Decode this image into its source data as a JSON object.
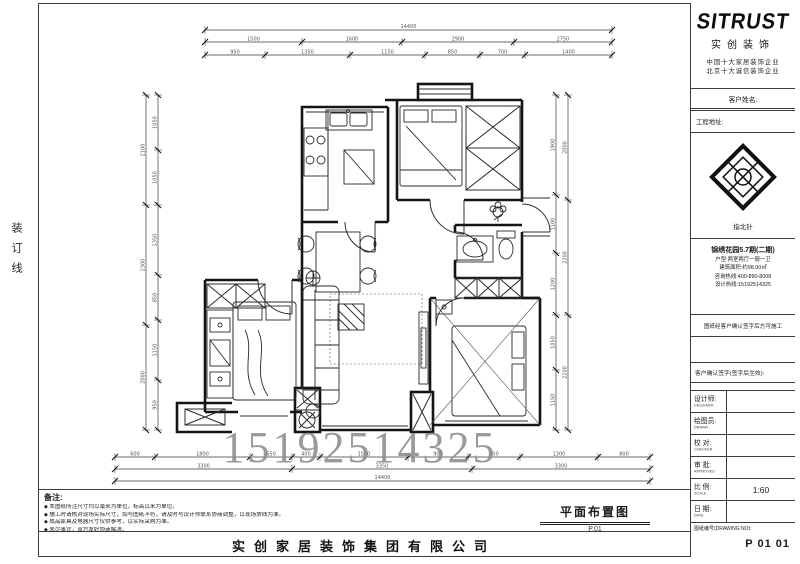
{
  "page": {
    "binding_text": "装订线"
  },
  "watermark": {
    "text": "15192514325"
  },
  "company": "实创家居装饰集团有限公司",
  "notes": {
    "heading": "备注:",
    "items": [
      "本图纸所注尺寸均以毫米为单位，标高以米为单位。",
      "施工时请核对现场实际尺寸，如与图纸不符，请及时与设计师联系协商调整，以现场放线为准。",
      "成品家具及电器尺寸仅供参考，以实际采购为准。",
      "未尽事宜，双方友好协商解决。"
    ]
  },
  "plan": {
    "title": "平面布置图",
    "title_sub": "P.01",
    "chains": [
      {
        "dir": "h",
        "x": 205,
        "y": 42,
        "segs": [
          {
            "len": 97,
            "label": "1500"
          },
          {
            "len": 100,
            "label": "1600"
          },
          {
            "len": 112,
            "label": "2900"
          },
          {
            "len": 98,
            "label": "2750"
          }
        ]
      },
      {
        "dir": "h",
        "x": 205,
        "y": 55,
        "segs": [
          {
            "len": 60,
            "label": "950"
          },
          {
            "len": 85,
            "label": "1350"
          },
          {
            "len": 75,
            "label": "1150"
          },
          {
            "len": 55,
            "label": "850"
          },
          {
            "len": 45,
            "label": "700"
          },
          {
            "len": 87,
            "label": "1400"
          }
        ]
      },
      {
        "dir": "h",
        "x": 115,
        "y": 457,
        "segs": [
          {
            "len": 40,
            "label": "600"
          },
          {
            "len": 95,
            "label": "1800"
          },
          {
            "len": 42,
            "label": "650"
          },
          {
            "len": 28,
            "label": "400"
          },
          {
            "len": 88,
            "label": "1500"
          },
          {
            "len": 60,
            "label": "900"
          },
          {
            "len": 52,
            "label": "800"
          },
          {
            "len": 78,
            "label": "1300"
          },
          {
            "len": 52,
            "label": "800"
          }
        ]
      },
      {
        "dir": "h",
        "x": 115,
        "y": 469,
        "segs": [
          {
            "len": 177,
            "label": "3300"
          },
          {
            "len": 180,
            "label": "3350"
          },
          {
            "len": 178,
            "label": "3300"
          }
        ]
      },
      {
        "dir": "v",
        "x": 146,
        "y": 95,
        "segs": [
          {
            "len": 110,
            "label": "2100"
          },
          {
            "len": 120,
            "label": "2300"
          },
          {
            "len": 105,
            "label": "2000"
          }
        ]
      },
      {
        "dir": "v",
        "x": 158,
        "y": 95,
        "segs": [
          {
            "len": 55,
            "label": "1050"
          },
          {
            "len": 55,
            "label": "1050"
          },
          {
            "len": 70,
            "label": "1350"
          },
          {
            "len": 45,
            "label": "850"
          },
          {
            "len": 60,
            "label": "1150"
          },
          {
            "len": 50,
            "label": "950"
          }
        ]
      },
      {
        "dir": "v",
        "x": 556,
        "y": 95,
        "segs": [
          {
            "len": 100,
            "label": "1900"
          },
          {
            "len": 58,
            "label": "1100"
          },
          {
            "len": 62,
            "label": "1200"
          },
          {
            "len": 55,
            "label": "1050"
          },
          {
            "len": 60,
            "label": "1150"
          }
        ]
      },
      {
        "dir": "v",
        "x": 568,
        "y": 95,
        "segs": [
          {
            "len": 105,
            "label": "2000"
          },
          {
            "len": 115,
            "label": "2200"
          },
          {
            "len": 115,
            "label": "2200"
          }
        ]
      }
    ],
    "overalls": [
      {
        "dir": "h",
        "x": 205,
        "y": 30,
        "len": 407,
        "label": "14400"
      },
      {
        "dir": "h",
        "x": 115,
        "y": 481,
        "len": 535,
        "label": "14400"
      }
    ]
  },
  "titleblock": {
    "logo": "SITRUST",
    "logo_cn": "实创装饰",
    "slogan1": "中国十大家居装饰企业",
    "slogan2": "北京十大诚信装饰企业",
    "row_customer": "客户姓名:",
    "row_address": "工程地址:",
    "compass_caption": "指北针",
    "info_lines": [
      "锦绣花园5.7期(二期)",
      "户型:两室两厅一厨一卫",
      "建筑面积:约98.00㎡",
      "咨询热线:400-890-8008",
      "设计热线:15192514325"
    ],
    "confirm_row": "图纸经客户确认签字后方可施工",
    "sign_row": "客户确认签字(签字后生效):",
    "fields": [
      {
        "label": "设计师:",
        "sub": "DESIGNER",
        "value": ""
      },
      {
        "label": "绘图员:",
        "sub": "DRAWN",
        "value": ""
      },
      {
        "label": "校 对:",
        "sub": "CHECKER",
        "value": ""
      },
      {
        "label": "审 批:",
        "sub": "APPROVED",
        "value": ""
      },
      {
        "label": "比 例:",
        "sub": "SCALE",
        "value": "1:60"
      },
      {
        "label": "日 期:",
        "sub": "DATE",
        "value": ""
      }
    ],
    "drawing_no_label": "图纸编号(DRAWING NO):",
    "drawing_no": "P 01 01"
  }
}
